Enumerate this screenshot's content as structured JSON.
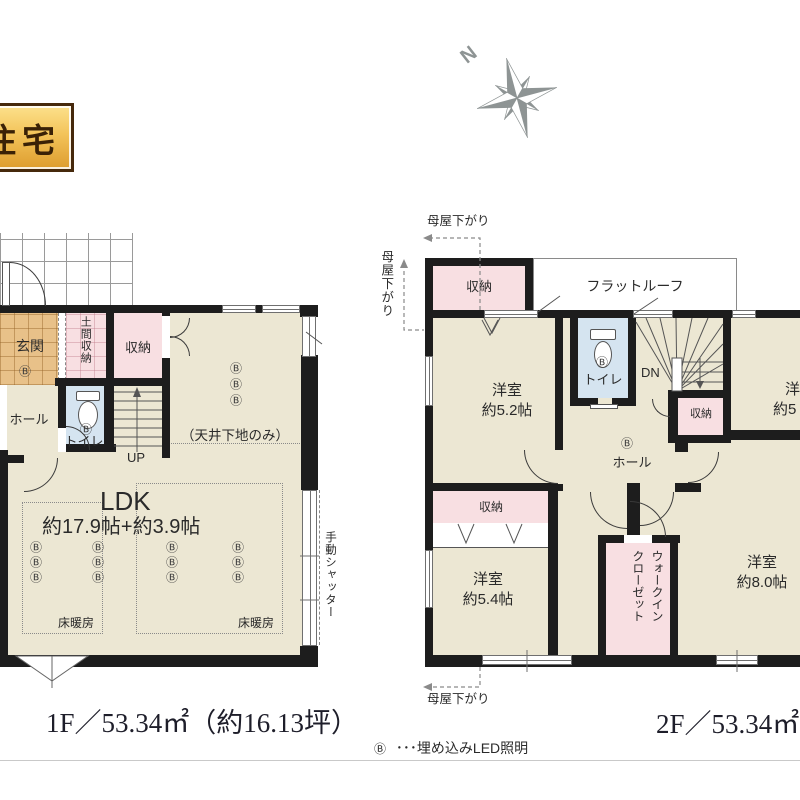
{
  "badge": {
    "label": "住宅"
  },
  "compass": {
    "north": "N"
  },
  "colors": {
    "wall": "#1d1d1d",
    "floor_beige": "#ece7d3",
    "storage_pink": "#f8dfe2",
    "toilet_blue": "#d5e4f0",
    "entry_tile": "#e8c189",
    "badge_gold": "#f3c359",
    "badge_border": "#46290c",
    "compass_gray": "#8e9494"
  },
  "floor1": {
    "title": "1F／53.34㎡（約16.13坪）",
    "labels": {
      "genkan": "玄関",
      "doma": "土間収納",
      "closet": "収納",
      "hall": "ホール",
      "toilet": "トイレ",
      "up": "UP",
      "ceiling_note": "（天井下地のみ）",
      "ldk": "LDK",
      "ldk_size": "約17.9帖+約3.9帖",
      "floor_heating": "床暖房",
      "shutter": "手動シャッター"
    }
  },
  "floor2": {
    "title": "2F／53.34㎡",
    "labels": {
      "moyasagari": "母屋下がり",
      "closet": "収納",
      "flat_roof": "フラットルーフ",
      "room_nw": "洋室",
      "room_nw_size": "約5.2帖",
      "toilet": "トイレ",
      "dn": "DN",
      "hall": "ホール",
      "room_sw": "洋室",
      "room_sw_size": "約5.4帖",
      "wic_line1": "ウォークイン",
      "wic_line2": "クローゼット",
      "room_se": "洋室",
      "room_se_size": "約8.0帖",
      "room_ne": "洋室",
      "room_ne_size": "約5"
    }
  },
  "legend": {
    "symbol": "Ⓑ",
    "text": "･･･埋め込みLED照明"
  },
  "sym": {
    "b": "Ⓑ"
  }
}
